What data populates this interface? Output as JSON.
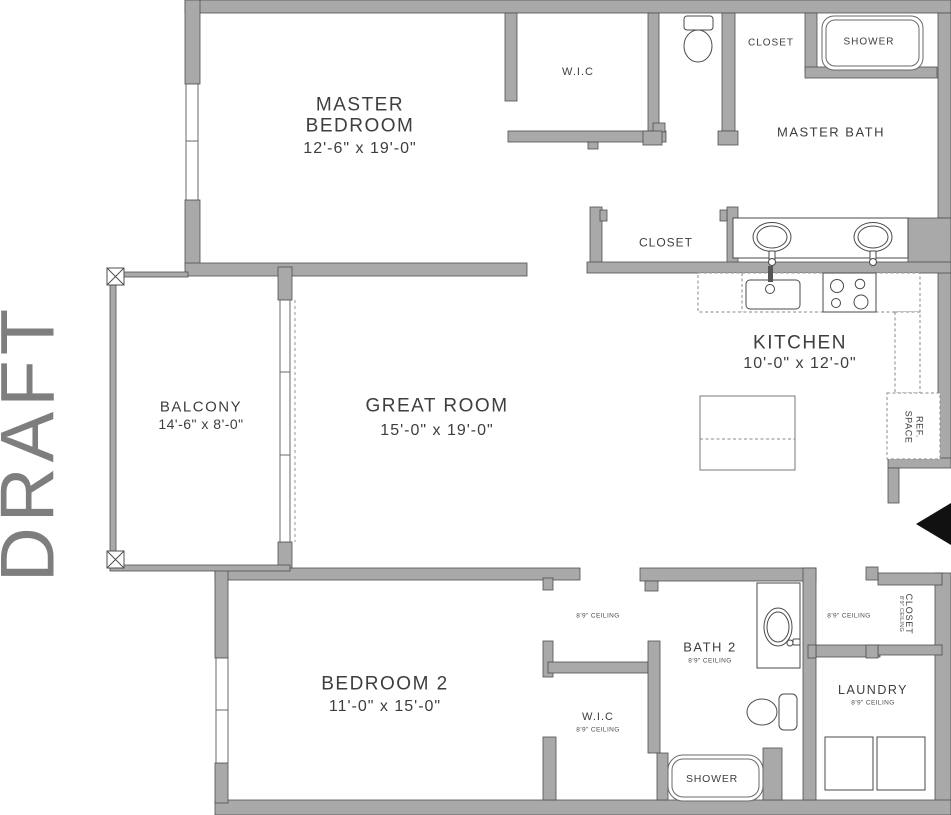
{
  "watermark": "DRAFT",
  "colors": {
    "wall_fill": "#a9a9a9",
    "wall_edge": "#4f4f4f",
    "label_text": "#3e3e3e",
    "watermark_gray": "#7e7e7e",
    "entry_arrow": "#111111"
  },
  "rooms": {
    "master_bedroom": {
      "name": "MASTER BEDROOM",
      "dims": "12'-6\" x 19'-0\""
    },
    "wic_top": {
      "name": "W.I.C"
    },
    "closet_top": {
      "name": "CLOSET"
    },
    "shower_top": {
      "name": "SHOWER"
    },
    "master_bath": {
      "name": "MASTER BATH"
    },
    "closet_mid": {
      "name": "CLOSET"
    },
    "kitchen": {
      "name": "KITCHEN",
      "dims": "10'-0\" x 12'-0\""
    },
    "ref_space": {
      "line1": "REF.",
      "line2": "SPACE"
    },
    "great_room": {
      "name": "GREAT ROOM",
      "dims": "15'-0\" x 19'-0\""
    },
    "balcony": {
      "name": "BALCONY",
      "dims": "14'-6\" x 8'-0\""
    },
    "bedroom2": {
      "name": "BEDROOM 2",
      "dims": "11'-0\" x 15'-0\""
    },
    "bath2": {
      "name": "BATH 2",
      "ceiling": "8'9\" CEILING"
    },
    "wic_bottom": {
      "name": "W.I.C",
      "ceiling": "8'9\" CEILING"
    },
    "laundry": {
      "name": "LAUNDRY",
      "ceiling": "8'9\" CEILING"
    },
    "shower_bottom": {
      "name": "SHOWER"
    },
    "closet_right": {
      "name": "CLOSET",
      "ceiling": "8'9\" CEILING"
    }
  },
  "hall_notes": {
    "left": "8'9\" CEILING",
    "right": "8'9\" CEILING"
  }
}
